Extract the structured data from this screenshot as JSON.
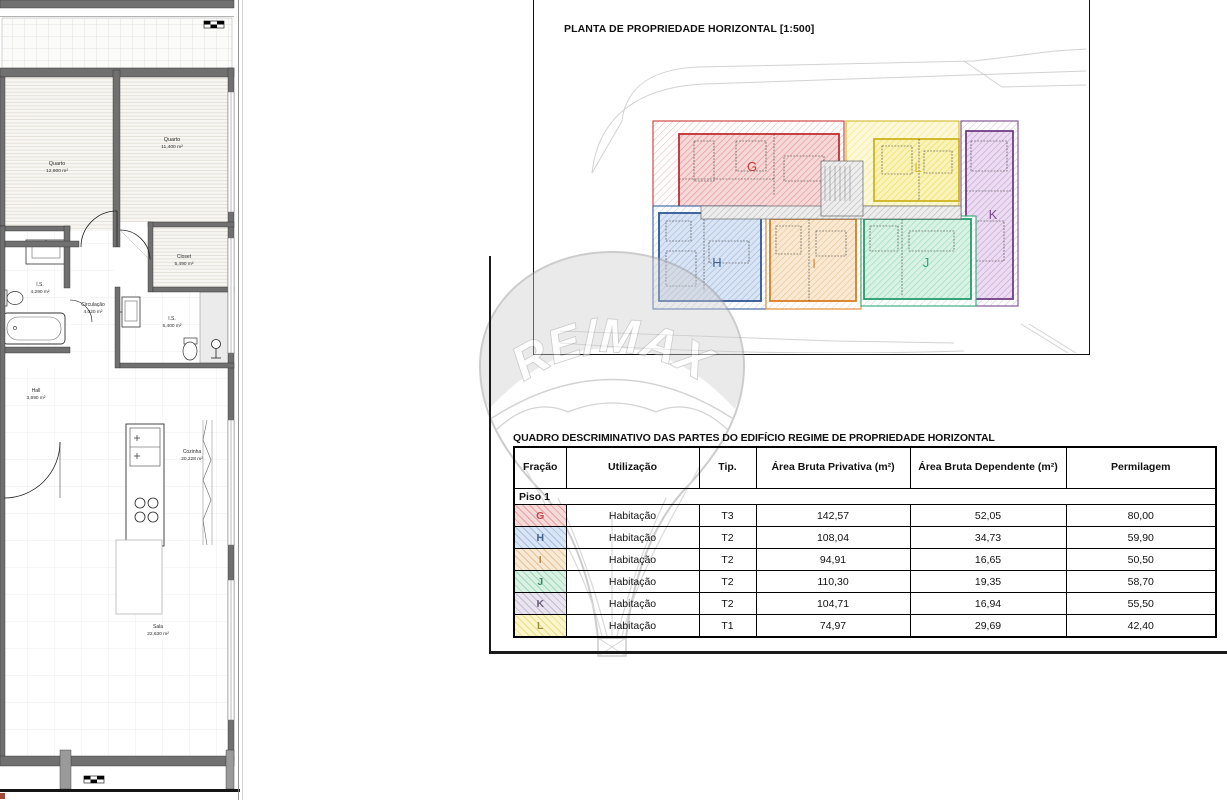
{
  "floorplan": {
    "rooms": [
      {
        "name": "Quarto",
        "area": "12,900 m²"
      },
      {
        "name": "Quarto",
        "area": "11,400 m²"
      },
      {
        "name": "Closet",
        "area": "5,490 m²"
      },
      {
        "name": "I.S.",
        "area": "4,290 m²"
      },
      {
        "name": "Circulação",
        "area": "4,020 m²"
      },
      {
        "name": "I.S.",
        "area": "5,400 m²"
      },
      {
        "name": "Hall",
        "area": "3,690 m²"
      },
      {
        "name": "Cozinha",
        "area": "20,228 m²"
      },
      {
        "name": "Sala",
        "area": "22,630 m²"
      }
    ]
  },
  "planta": {
    "title": "PLANTA DE PROPRIEDADE HORIZONTAL [1:500]",
    "units": [
      {
        "label": "G",
        "color": "#cc3a3a"
      },
      {
        "label": "H",
        "color": "#3a62a0"
      },
      {
        "label": "I",
        "color": "#e0862e"
      },
      {
        "label": "J",
        "color": "#2fa878"
      },
      {
        "label": "K",
        "color": "#7a4a8e"
      },
      {
        "label": "L",
        "color": "#d4b92a"
      }
    ]
  },
  "watermark": {
    "brand": "RE/MAX"
  },
  "quadro": {
    "title": "QUADRO DESCRIMINATIVO DAS PARTES DO EDIFÍCIO REGIME DE PROPRIEDADE HORIZONTAL",
    "columns": [
      "Fração",
      "Utilização",
      "Tip.",
      "Área Bruta Privativa (m²)",
      "Área Bruta Dependente (m²)",
      "Permilagem"
    ],
    "section": "Piso 1",
    "rows": [
      {
        "fracao": "G",
        "utilizacao": "Habitação",
        "tip": "T3",
        "privativa": "142,57",
        "dependente": "52,05",
        "permilagem": "80,00",
        "cell_bg": "#f6d9d9",
        "hatch": "#e5a0a0",
        "letter_color": "#bf4a4a"
      },
      {
        "fracao": "H",
        "utilizacao": "Habitação",
        "tip": "T2",
        "privativa": "108,04",
        "dependente": "34,73",
        "permilagem": "59,90",
        "cell_bg": "#d9e5f5",
        "hatch": "#a6bfdf",
        "letter_color": "#46648f"
      },
      {
        "fracao": "I",
        "utilizacao": "Habitação",
        "tip": "T2",
        "privativa": "94,91",
        "dependente": "16,65",
        "permilagem": "50,50",
        "cell_bg": "#f8e9d4",
        "hatch": "#e3c298",
        "letter_color": "#b8854a"
      },
      {
        "fracao": "J",
        "utilizacao": "Habitação",
        "tip": "T2",
        "privativa": "110,30",
        "dependente": "19,35",
        "permilagem": "58,70",
        "cell_bg": "#d9f1e3",
        "hatch": "#9fd7ba",
        "letter_color": "#3f8a64"
      },
      {
        "fracao": "K",
        "utilizacao": "Habitação",
        "tip": "T2",
        "privativa": "104,71",
        "dependente": "16,94",
        "permilagem": "55,50",
        "cell_bg": "#e9e4ee",
        "hatch": "#c3b9d1",
        "letter_color": "#6d5f80"
      },
      {
        "fracao": "L",
        "utilizacao": "Habitação",
        "tip": "T1",
        "privativa": "74,97",
        "dependente": "29,69",
        "permilagem": "42,40",
        "cell_bg": "#fbf6c9",
        "hatch": "#e9dd8e",
        "letter_color": "#9a8f3a"
      }
    ]
  }
}
